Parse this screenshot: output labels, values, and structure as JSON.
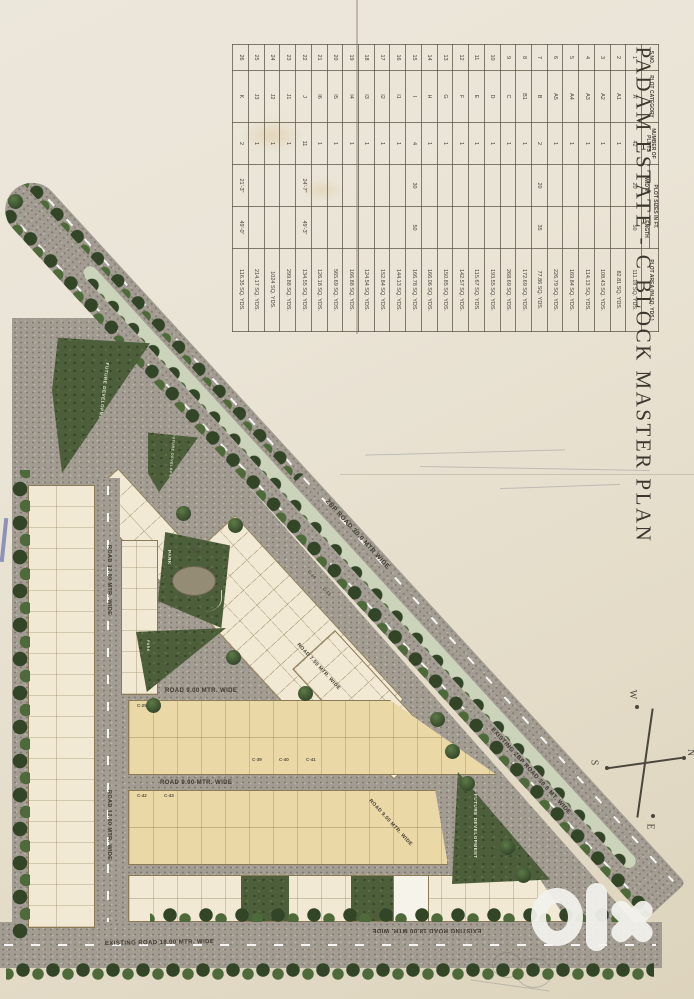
{
  "title": "PADAM ESTATE - C BLOCK MASTER PLAN",
  "table": {
    "headers": {
      "sno": "S.NO.",
      "category": "PLOT CATEGORY",
      "plots": "NUMBER OF PLOTS",
      "sizes": "PLOT SIZES IN FT.",
      "width": "WIDTH",
      "length": "LENGTH",
      "area": "PLOT AREA (IN SQ. YDS.)"
    },
    "rows": [
      [
        "1",
        "A",
        "42",
        "20",
        "50",
        "111.18 SQ. YDS."
      ],
      [
        "2",
        "A1",
        "1",
        "",
        "",
        "82.81 SQ. YDS."
      ],
      [
        "3",
        "A2",
        "1",
        "",
        "",
        "108.43 SQ. YDS."
      ],
      [
        "4",
        "A3",
        "1",
        "",
        "",
        "114.13 SQ. YDS."
      ],
      [
        "5",
        "A4",
        "1",
        "",
        "",
        "169.84 SQ. YDS."
      ],
      [
        "6",
        "A5",
        "1",
        "",
        "",
        "226.79 SQ. YDS."
      ],
      [
        "7",
        "B",
        "2",
        "20",
        "35",
        "77.86 SQ. YDS."
      ],
      [
        "8",
        "B1",
        "1",
        "",
        "",
        "172.69 SQ. YDS."
      ],
      [
        "9",
        "C",
        "1",
        "",
        "",
        "268.69 SQ. YDS."
      ],
      [
        "10",
        "D",
        "1",
        "",
        "",
        "193.55 SQ. YDS."
      ],
      [
        "11",
        "E",
        "1",
        "",
        "",
        "115.67 SQ. YDS."
      ],
      [
        "12",
        "F",
        "1",
        "",
        "",
        "142.57 SQ. YDS."
      ],
      [
        "13",
        "G",
        "1",
        "",
        "",
        "150.85 SQ. YDS."
      ],
      [
        "14",
        "H",
        "1",
        "",
        "",
        "166.06 SQ. YDS."
      ],
      [
        "15",
        "I",
        "4",
        "30",
        "50",
        "166.78 SQ. YDS."
      ],
      [
        "16",
        "I1",
        "1",
        "",
        "",
        "144.13 SQ. YDS."
      ],
      [
        "17",
        "I2",
        "1",
        "",
        "",
        "152.84 SQ. YDS."
      ],
      [
        "18",
        "I3",
        "1",
        "",
        "",
        "124.54 SQ. YDS."
      ],
      [
        "19",
        "I4",
        "1",
        "",
        "",
        "166.88 SQ. YDS."
      ],
      [
        "20",
        "I5",
        "1",
        "",
        "",
        "565.69 SQ. YDS."
      ],
      [
        "21",
        "I6",
        "1",
        "",
        "",
        "126.18 SQ. YDS."
      ],
      [
        "22",
        "J",
        "11",
        "24'-7\"",
        "49'-3\"",
        "134.55 SQ. YDS."
      ],
      [
        "23",
        "J1",
        "1",
        "",
        "",
        "299.88 SQ. YDS."
      ],
      [
        "24",
        "J2",
        "1",
        "",
        "",
        "1024 SQ. YDS."
      ],
      [
        "25",
        "J3",
        "1",
        "",
        "",
        "214.17 SQ. YDS."
      ],
      [
        "26",
        "K",
        "2",
        "21'-3\"",
        "49'-0\"",
        "116.35 SQ. YDS."
      ]
    ]
  },
  "map": {
    "roads": {
      "zbp": "ZBP ROAD 30.0 MTR WIDE",
      "existing_zbp": "EXISTING ZBP ROAD 30.0 MT. WIDE",
      "existing_18": "EXISTING ROAD 18.00 MTR. WIDE",
      "road_12": "ROAD 12.00 MTR. WIDE",
      "road_9": "ROAD 9.00 MTR. WIDE",
      "road_7_5": "ROAD 7.50 MTR. WIDE"
    },
    "areas": {
      "future_development": "FUTURE DEVELOPMENT",
      "park": "PARK"
    },
    "compass": {
      "n": "N",
      "s": "S",
      "e": "E",
      "w": "W"
    },
    "plot_labels": [
      "C-23",
      "C-24",
      "C-14",
      "C-13",
      "C-25",
      "C-39",
      "C-40",
      "C-41",
      "C-42",
      "C-43"
    ],
    "watermark": "olx"
  },
  "colors": {
    "paper": "#e9e3d4",
    "road_gray": "#a29c92",
    "plot_cream": "#f1e9d3",
    "plot_tan": "#ead8a6",
    "green": "#4c5e3a",
    "tree_dark": "#324527",
    "watermark_white": "#f3f3ee"
  }
}
